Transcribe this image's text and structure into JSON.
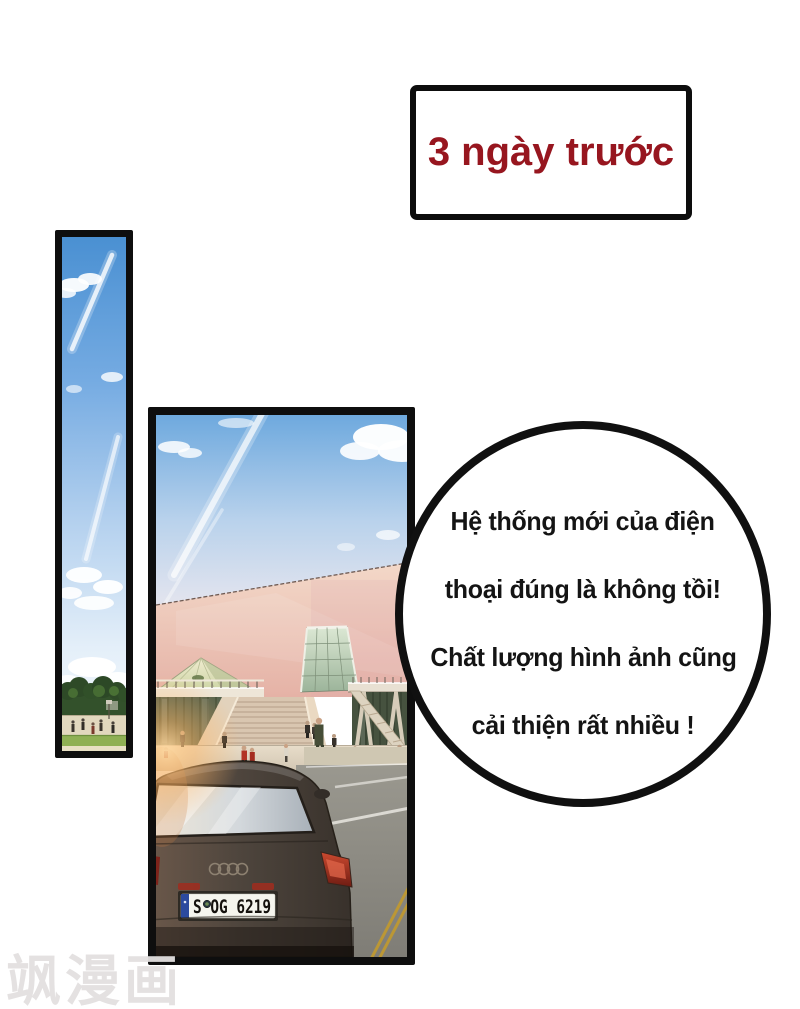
{
  "caption_box": {
    "text": "3 ngày trước",
    "text_color": "#97161f"
  },
  "speech_bubble": {
    "lines": [
      "Hệ thống mới của điện",
      "thoại đúng là không tồi!",
      "Chất lượng hình ảnh cũng",
      "cải thiện rất nhiều !"
    ]
  },
  "building_panel": {
    "license_plate": "S OG 6219"
  },
  "watermark": {
    "text": "飒漫画"
  },
  "colors": {
    "background": "#ffffff",
    "panel_border": "#0e0e0e",
    "caption_red": "#97161f",
    "bubble_border": "#101010",
    "sky_blue": "#6ea9de",
    "wall_pink": "#ecc3b2",
    "grass_green": "#8fb054",
    "taillight_red": "#b03a28",
    "plate_blue": "#2c4a9e",
    "road_yellow_line": "#c29a2e"
  }
}
